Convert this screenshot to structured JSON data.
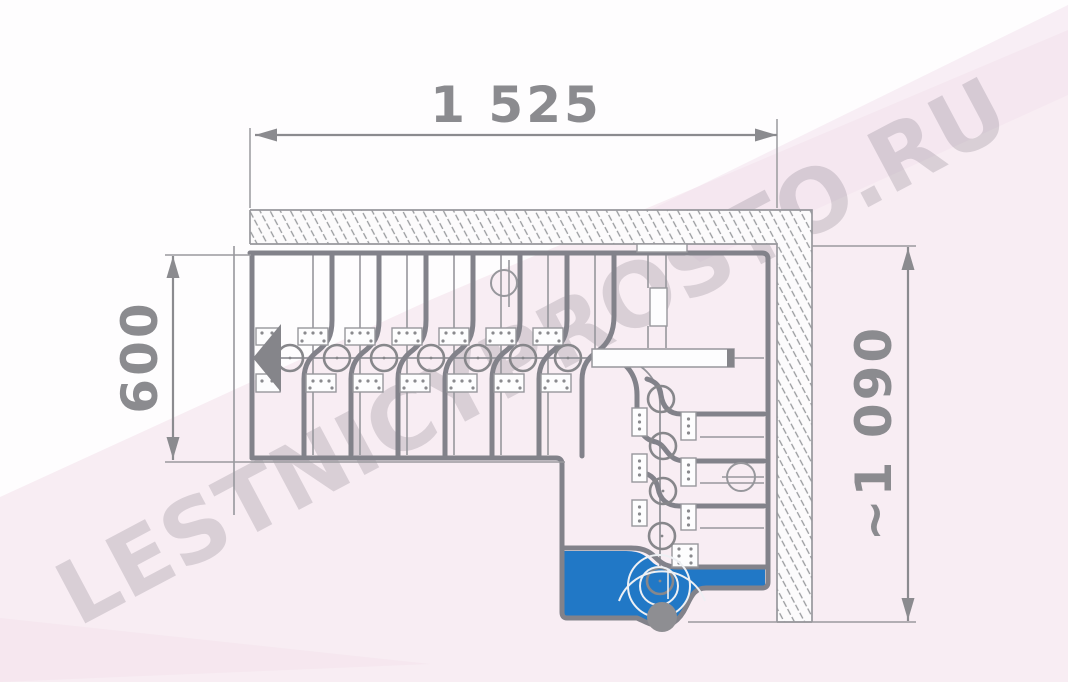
{
  "drawing": {
    "title_semantic": "staircase-plan-view",
    "dimensions": {
      "top_width": "1 525",
      "left_depth": "600",
      "right_height": "~1 090"
    },
    "watermark": "LESTNICYPROSTO.RU",
    "colors": {
      "accent_blue": "#2178c6",
      "line_gray_thick": "#82828a",
      "line_gray_thin": "#97979c",
      "dimension_gray": "#8b8b8f",
      "watermark_gray": "#d9d4d7",
      "background_pink": "#f8edf3",
      "wall_fill": "#fcfbfc",
      "post_gray": "#8e8e92"
    }
  }
}
